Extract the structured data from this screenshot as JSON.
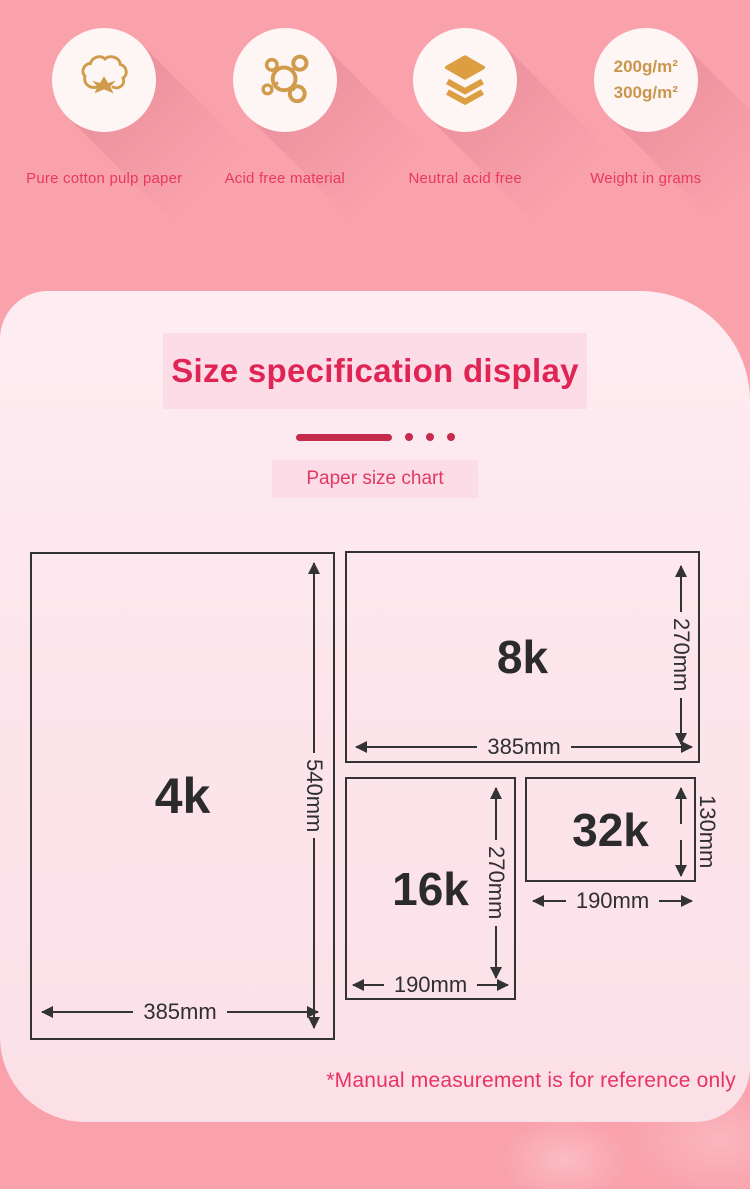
{
  "features": [
    {
      "icon": "cotton-icon",
      "label": "Pure cotton pulp paper"
    },
    {
      "icon": "molecule-icon",
      "label": "Acid free material"
    },
    {
      "icon": "layers-icon",
      "label": "Neutral acid free"
    },
    {
      "icon": "weight-text",
      "label": "Weight in grams",
      "lines": [
        "200g/m²",
        "300g/m²"
      ]
    }
  ],
  "panel": {
    "title": "Size specification display",
    "chart_label": "Paper size chart",
    "note": "*Manual measurement is for reference only"
  },
  "diagram": {
    "rects": [
      {
        "name": "4k",
        "width_mm": 385,
        "height_mm": 540,
        "width_label": "385mm",
        "height_label": "540mm"
      },
      {
        "name": "8k",
        "width_mm": 385,
        "height_mm": 270,
        "width_label": "385mm",
        "height_label": "270mm"
      },
      {
        "name": "16k",
        "width_mm": 190,
        "height_mm": 270,
        "width_label": "190mm",
        "height_label": "270mm"
      },
      {
        "name": "32k",
        "width_mm": 190,
        "height_mm": 130,
        "width_label": "190mm",
        "height_label": "130mm"
      }
    ]
  },
  "colors": {
    "background_pink": "#f9a2ac",
    "panel_pink": "#fce6ed",
    "banner_pink": "#fbdce7",
    "accent_red": "#e02454",
    "label_red": "#e8395f",
    "divider_red": "#c62a4c",
    "gold": "#d09b4b",
    "line_dark": "#333333"
  }
}
